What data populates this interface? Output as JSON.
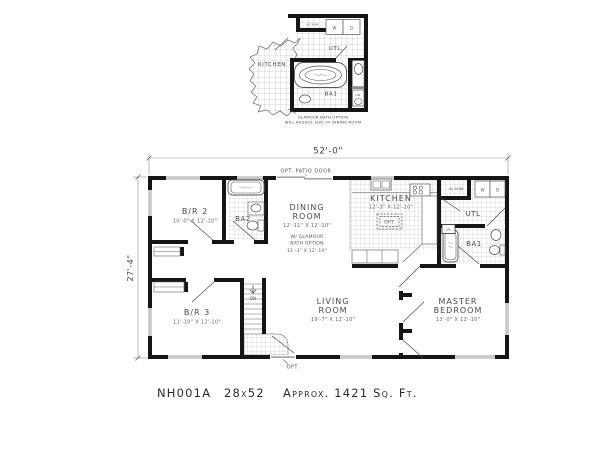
{
  "inset": {
    "kitchen_label": "KITCHEN",
    "utility_label": "UTL.",
    "shower_label": "42 SHW",
    "washer_label": "W",
    "dryer_label": "D",
    "bath_label": "BA1",
    "linen_label": "LIN.",
    "caption_line1": "GLAMOUR BATH  OPTION",
    "caption_line2": "WILL REDUCE SIZE OF DINING ROOM"
  },
  "main": {
    "width_dim": "52'-0\"",
    "height_dim": "27'-4\"",
    "patio_note": "OPT.  PATIO  DOOR",
    "entry_note": "OPT.",
    "stairs_label": "DN",
    "rooms": {
      "br2": {
        "name": "B/R 2",
        "dims": "10'-0\" X 12'-10\""
      },
      "ba2": {
        "name": "BA2"
      },
      "dining": {
        "name1": "DINING",
        "name2": "ROOM",
        "dims": "12'-11\" X 12'-10\"",
        "alt1": "W/ GLAMOUR",
        "alt2": "BATH OPTION",
        "alt3": "11'-3\" X 12'-10\""
      },
      "kitchen": {
        "name": "KITCHEN",
        "dims": "12'-3\" X 12'-10\"",
        "island": "OPT."
      },
      "utility": {
        "name": "UTL",
        "washer": "W",
        "dryer": "D",
        "shower": "42 SHW",
        "linen": "LIN."
      },
      "ba1": {
        "name": "BA1"
      },
      "master": {
        "name1": "MASTER",
        "name2": "BEDROOM",
        "dims": "13'-0\" X 12'-10\""
      },
      "living": {
        "name1": "LIVING",
        "name2": "ROOM",
        "dims": "19'-7\" X 12'-10\""
      },
      "br3": {
        "name": "B/R 3",
        "dims": "11'-10\" X 12'-10\""
      }
    }
  },
  "footer": {
    "model": "NH001A",
    "size": "28x52",
    "area": "Approx. 1421 Sq. Ft."
  },
  "colors": {
    "wall": "#151515",
    "line": "#555555",
    "tile": "#b8b8b8",
    "dimension": "#8a8a8a",
    "glass": "#909090",
    "background": "#ffffff"
  }
}
